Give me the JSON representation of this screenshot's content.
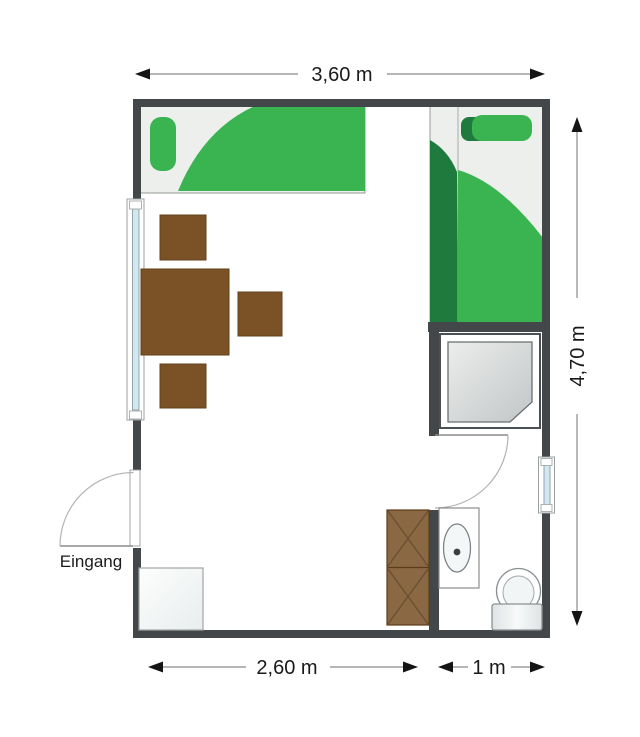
{
  "plan": {
    "type": "floor-plan",
    "entrance_label": "Eingang",
    "dimensions": {
      "top_width": "3,60 m",
      "right_height": "4,70 m",
      "bottom_main_width": "2,60 m",
      "bottom_bath_width": "1 m"
    },
    "colors": {
      "wall": "#434749",
      "bed_base": "#ecefec",
      "bed_green": "#3ab351",
      "bed_green_dark": "#1f7a3e",
      "table_brown": "#7a5226",
      "wardrobe_brown": "#8a6843",
      "window_glass": "#cfe9f2",
      "shower_gray": "#c6c9c9",
      "dimension_line": "#8b8b8b",
      "text": "#1a1a1a"
    }
  }
}
